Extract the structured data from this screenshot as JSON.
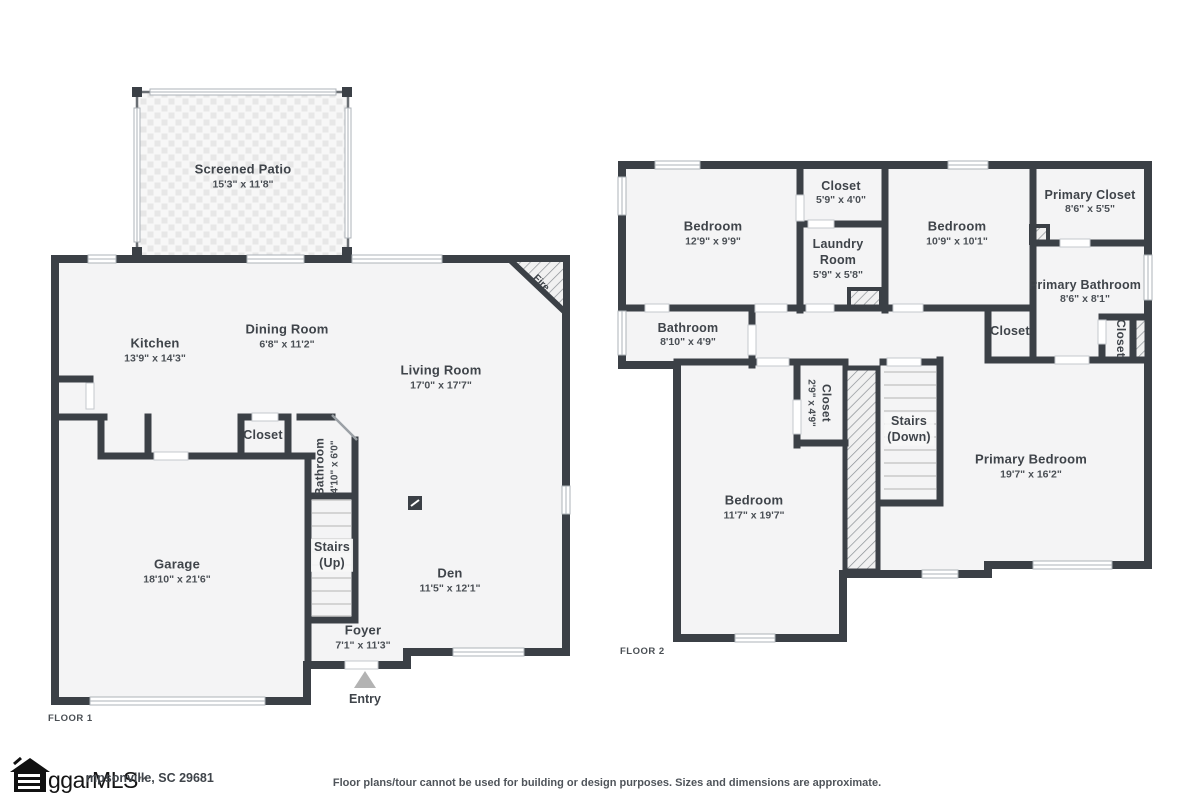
{
  "floor1": {
    "caption": "FLOOR 1",
    "fire_label": "Fire",
    "entry_label": "Entry",
    "rooms": {
      "patio": {
        "name": "Screened Patio",
        "dims": "15'3\" x 11'8\""
      },
      "kitchen": {
        "name": "Kitchen",
        "dims": "13'9\" x 14'3\""
      },
      "dining": {
        "name": "Dining Room",
        "dims": "6'8\" x 11'2\""
      },
      "living": {
        "name": "Living Room",
        "dims": "17'0\" x 17'7\""
      },
      "closet": {
        "name": "Closet"
      },
      "bathroom": {
        "name": "Bathroom",
        "dims": "4'10\" x 6'0\""
      },
      "garage": {
        "name": "Garage",
        "dims": "18'10\" x 21'6\""
      },
      "stairs": {
        "name": "Stairs",
        "dims": "(Up)"
      },
      "foyer": {
        "name": "Foyer",
        "dims": "7'1\" x 11'3\""
      },
      "den": {
        "name": "Den",
        "dims": "11'5\" x 12'1\""
      }
    }
  },
  "floor2": {
    "caption": "FLOOR 2",
    "rooms": {
      "bedroom_a": {
        "name": "Bedroom",
        "dims": "12'9\" x 9'9\""
      },
      "closet_top": {
        "name": "Closet",
        "dims": "5'9\" x 4'0\""
      },
      "laundry": {
        "name": "Laundry Room",
        "dims": "5'9\" x 5'8\""
      },
      "bedroom_b": {
        "name": "Bedroom",
        "dims": "10'9\" x 10'1\""
      },
      "primary_closet": {
        "name": "Primary Closet",
        "dims": "8'6\" x 5'5\""
      },
      "primary_bathroom": {
        "name": "Primary Bathroom",
        "dims": "8'6\" x 8'1\""
      },
      "bathroom": {
        "name": "Bathroom",
        "dims": "8'10\" x 4'9\""
      },
      "hall_closet": {
        "name": "Closet"
      },
      "right_closet": {
        "name": "Closet"
      },
      "small_closet": {
        "name": "Closet",
        "dims": "2'9\" x 4'9\""
      },
      "stairs": {
        "name": "Stairs",
        "dims": "(Down)"
      },
      "primary_bedroom": {
        "name": "Primary Bedroom",
        "dims": "19'7\" x 16'2\""
      },
      "bedroom_c": {
        "name": "Bedroom",
        "dims": "11'7\" x 19'7\""
      }
    }
  },
  "footer": {
    "logo_text": "ggarMLS",
    "logo_tm": "™",
    "address": "mpsonville, SC 29681",
    "disclaimer": "Floor plans/tour cannot be used for building or design purposes. Sizes and dimensions are approximate."
  }
}
